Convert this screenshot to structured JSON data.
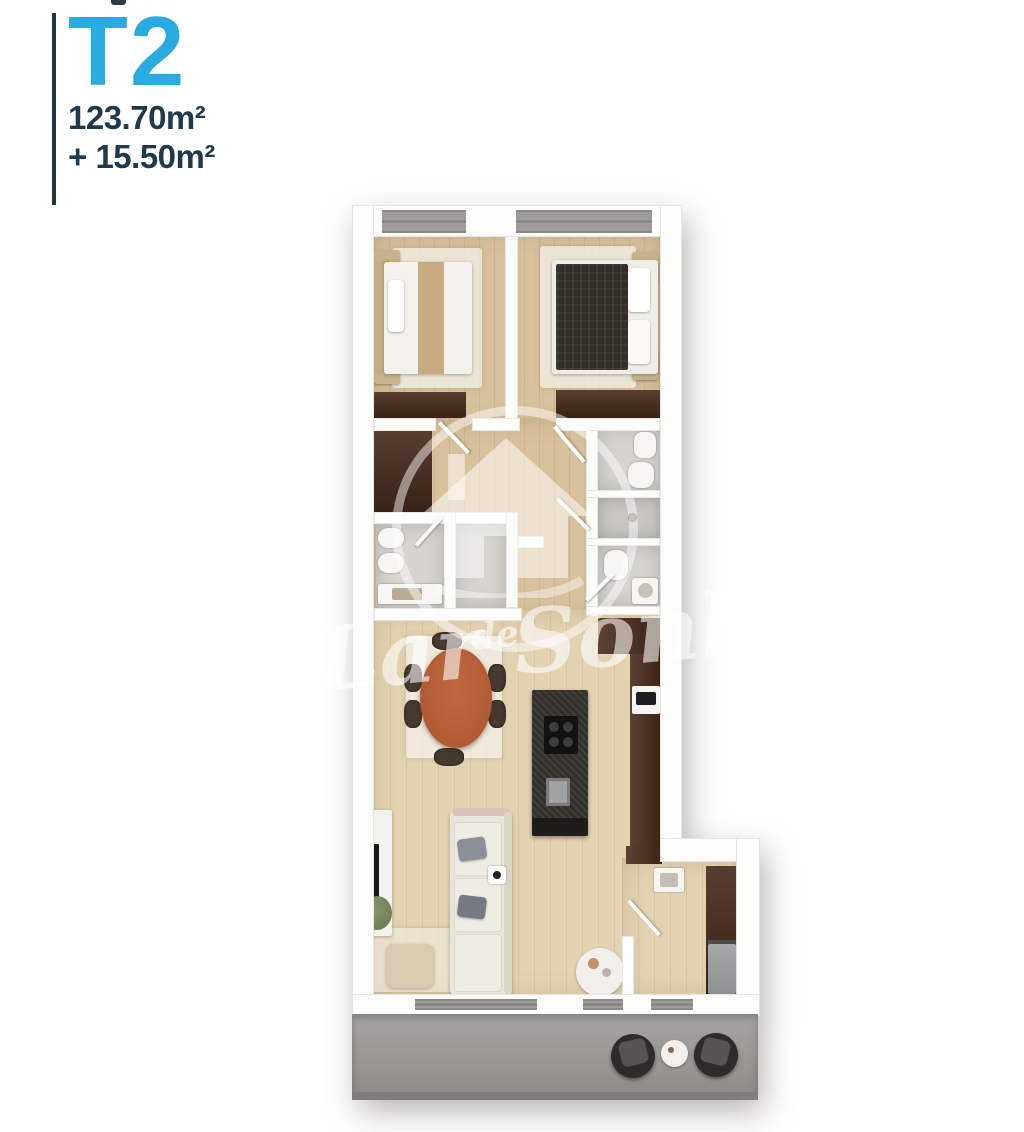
{
  "header": {
    "type_label": "T2",
    "area_main": "123.70m²",
    "area_extra": "+ 15.50m²",
    "accent_color": "#29abe2",
    "text_color": "#1f3a4d"
  },
  "watermark": {
    "word1": "Lar",
    "word2": "de",
    "word3": "Sonho",
    "logo": "house-logo-icon",
    "color": "rgba(255,255,255,0.55)"
  },
  "floorplan": {
    "style": "top-down 3D render",
    "rooms": [
      "bedroom-1",
      "bedroom-2",
      "hallway",
      "bathroom-left",
      "bathroom-right-top",
      "shower-room",
      "bathroom-right-bottom",
      "closet-nook",
      "living-dining-kitchen",
      "laundry-room",
      "terrace"
    ],
    "colors": {
      "wood_floor": "#d8c19d",
      "living_floor": "#e3d3b2",
      "bath_tile": "#d6d4cf",
      "wardrobe_dark": "#44291a",
      "kitchen_island": "#33302c",
      "terrace_concrete": "#9c9a97",
      "walls": "#fcfcfa"
    }
  }
}
